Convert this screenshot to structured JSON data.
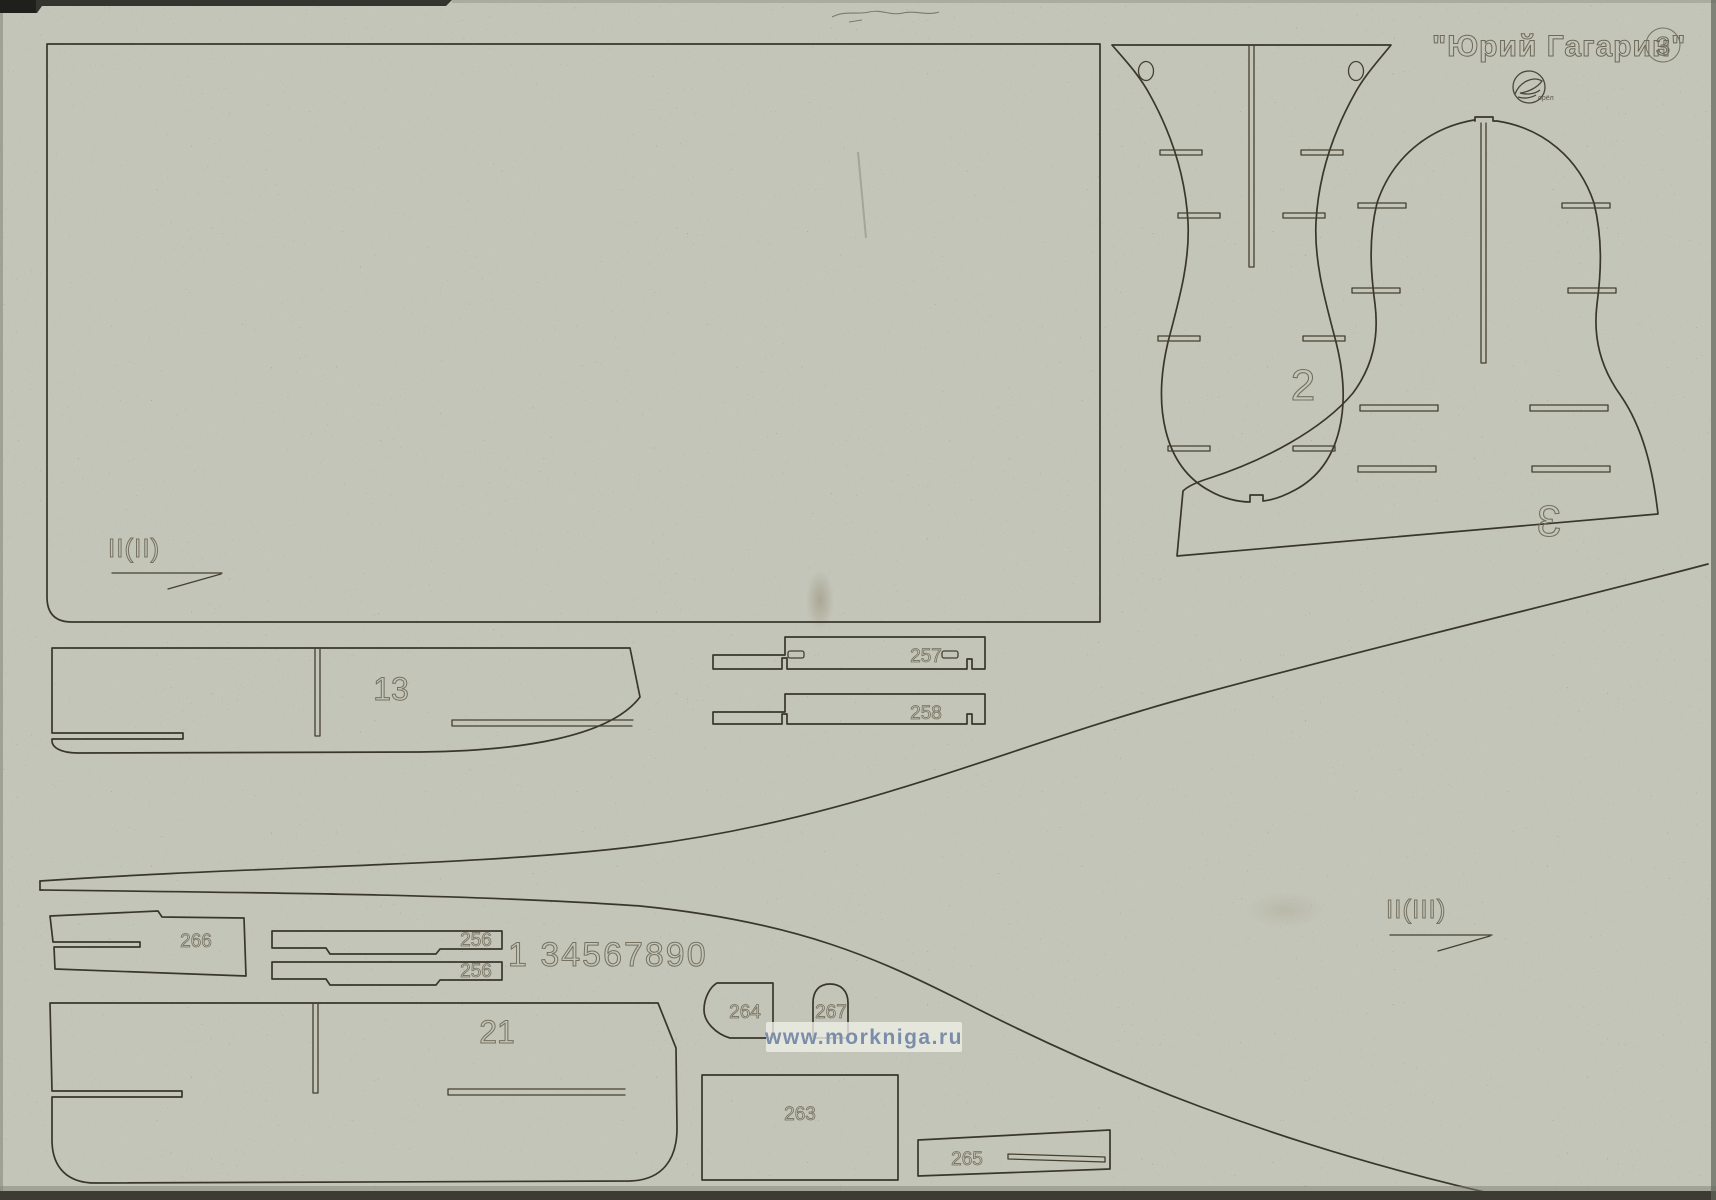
{
  "header": {
    "title": "\"Юрий Гагарин\"",
    "sheet_number": "3",
    "logo_text": "орёл"
  },
  "panel_labels": {
    "large_panel": "II(II)",
    "hull_panel": "II(III)",
    "calibration_row": "1 34567890"
  },
  "parts": {
    "p2": "2",
    "p3": "3",
    "p13": "13",
    "p21": "21",
    "p256a": "256",
    "p256b": "256",
    "p257": "257",
    "p258": "258",
    "p263": "263",
    "p264": "264",
    "p265": "265",
    "p266": "266",
    "p267": "267"
  },
  "watermark": "www.morkniga.ru",
  "colors": {
    "sheet": "#a9ac9c",
    "cut_line": "#3a362b",
    "engraving": "#76715f",
    "watermark_text": "#7b8ea9",
    "watermark_bg": "#edeee5",
    "hole_fill": "#f3f5ee"
  }
}
